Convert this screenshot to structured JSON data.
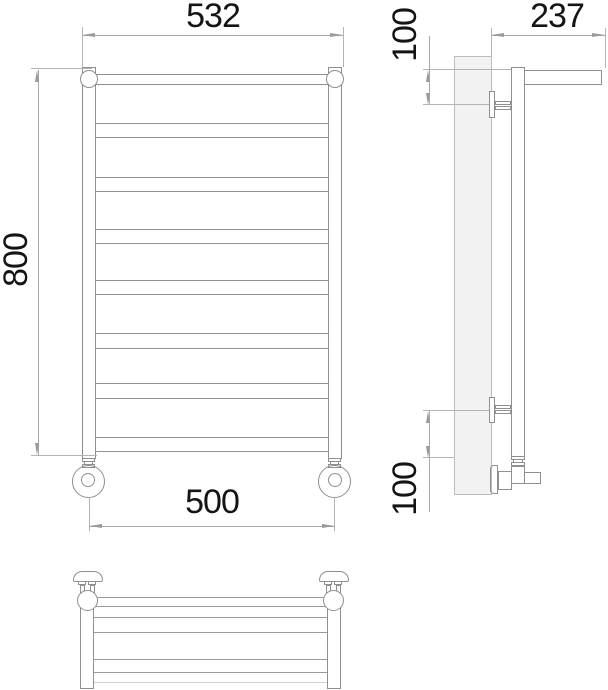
{
  "drawing": {
    "title": "Heated towel rail with shelf - dimensional drawing, three views",
    "views": [
      "front view",
      "side view",
      "plan view"
    ],
    "units": "mm",
    "line_color": "#8f8f8f",
    "dimension_line_color": "#a9a9a9",
    "text_color": "#141414",
    "wall_fill": "#f2f2f2"
  },
  "dimensions": {
    "front_top_width": "532",
    "front_height": "800",
    "front_bottom_width": "500",
    "side_depth": "237",
    "side_top_offset": "100",
    "side_bottom_offset": "100"
  },
  "front_view": {
    "rail_count_total": 8,
    "rungs": [
      [
        123,
        137
      ],
      [
        177,
        191
      ],
      [
        229,
        243
      ],
      [
        280,
        294
      ],
      [
        333,
        348
      ],
      [
        383,
        398
      ],
      [
        437,
        451
      ]
    ]
  },
  "plan_view": {
    "bar_lines": [
      {
        "y": 597,
        "light": false
      },
      {
        "y": 606,
        "light": false
      },
      {
        "y": 617,
        "light": false
      },
      {
        "y": 632,
        "light": false
      },
      {
        "y": 659,
        "light": false
      },
      {
        "y": 672,
        "light": false
      },
      {
        "y": 682,
        "light": true
      }
    ]
  }
}
